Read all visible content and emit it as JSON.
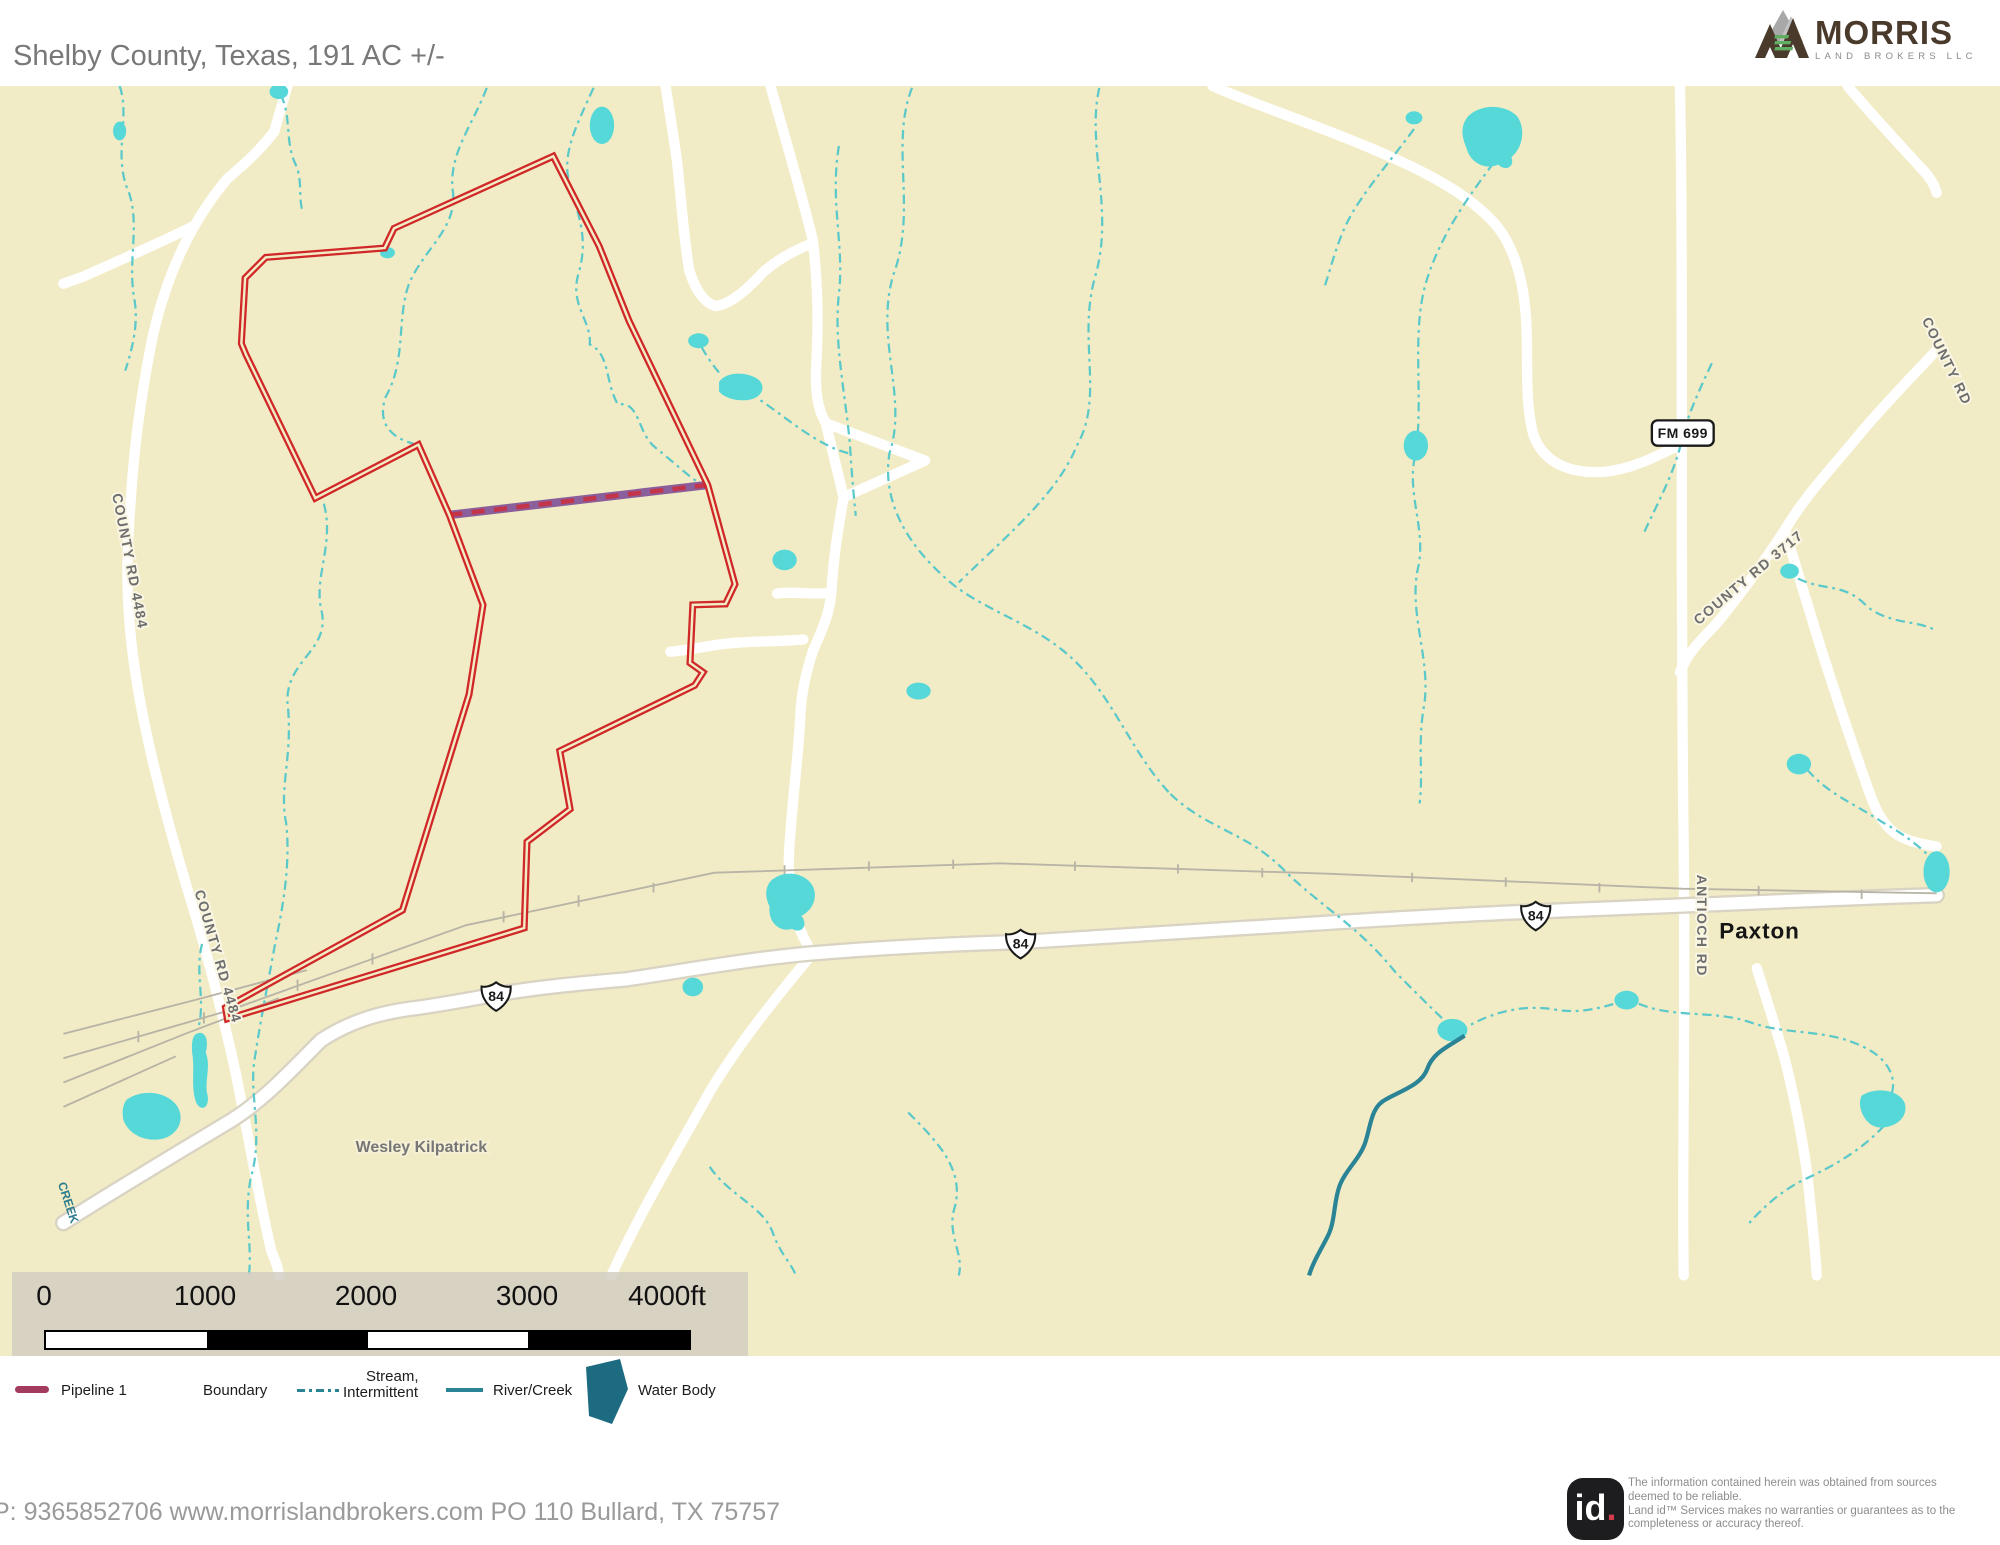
{
  "title": "Shelby County, Texas, 191 AC +/-",
  "brand": {
    "name": "MORRIS",
    "subtitle": "LAND BROKERS LLC"
  },
  "map": {
    "labels": {
      "county_rd_4484": "COUNTY RD 4484",
      "county_rd_3717": "COUNTY RD 3717",
      "county_rd_partial": "COUNTY RD",
      "antioch_rd": "ANTIOCH RD",
      "fm_699": "FM 699",
      "hwy_84": "84",
      "paxton": "Paxton",
      "wesley_kilpatrick": "Wesley Kilpatrick",
      "creek_partial": "CREEK"
    },
    "property": {
      "acreage_label": "191 AC +/-",
      "county": "Shelby County, Texas"
    },
    "colors": {
      "background": "#f2ecc6",
      "boundary": "#d02828",
      "pipeline_base": "#8a5f9b",
      "pipeline_dash": "#c2354b",
      "stream": "#5bc8ca",
      "river": "#2a8496",
      "water": "#57d8d8",
      "road": "#ffffff",
      "railroad": "#b8b4a6"
    }
  },
  "scale_bar": {
    "ticks": [
      "0",
      "1000",
      "2000",
      "3000"
    ],
    "end_label": "4000ft"
  },
  "legend": {
    "pipeline": "Pipeline 1",
    "boundary": "Boundary",
    "stream_line1": "Stream,",
    "stream_line2": "Intermittent",
    "river": "River/Creek",
    "water": "Water Body",
    "pipeline_color": "#a23b5e",
    "stream_color": "#2a8496",
    "river_color": "#2a8496",
    "water_color": "#1d6b80"
  },
  "footer": {
    "contact": "P: 9365852706 www.morrislandbrokers.com PO 110 Bullard, TX 75757"
  },
  "disclaimer": {
    "logo_text": "id",
    "lines": [
      "The information contained herein was obtained from sources",
      "deemed to be reliable.",
      "Land id™ Services makes no warranties or guarantees as to the",
      "completeness or accuracy thereof."
    ]
  }
}
